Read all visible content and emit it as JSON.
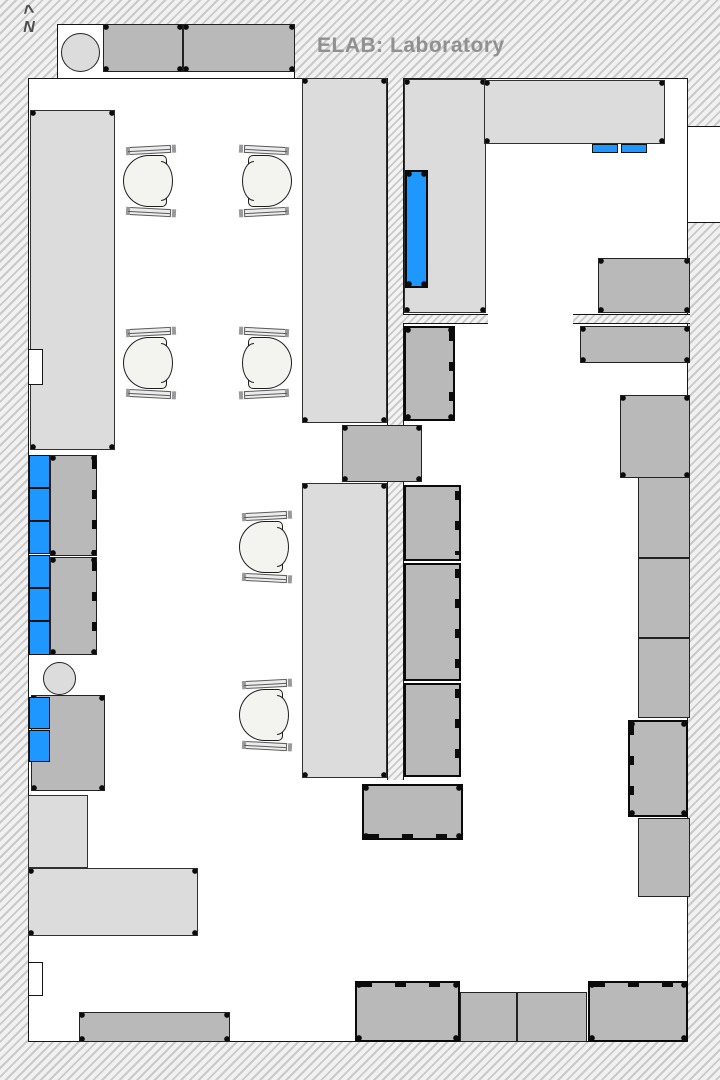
{
  "meta": {
    "title": "ELAB: Laboratory",
    "north_label": "N",
    "north_caret": "^"
  },
  "colors": {
    "accent_blue": "#1e97ff",
    "counter_light": "#dcdcdc",
    "equipment_gray": "#b9b9b9",
    "hatch_line": "#c9c9c9",
    "title_gray": "#909090",
    "seat_fill": "#f3f3ef"
  },
  "floorplan": {
    "rooms": [
      {
        "name": "room-floor",
        "x": 28,
        "y": 78,
        "w": 660,
        "h": 964,
        "cls": []
      },
      {
        "name": "wall-niche",
        "x": 57,
        "y": 24,
        "w": 238,
        "h": 55,
        "cls": []
      },
      {
        "name": "wall-opening-right",
        "x": 688,
        "y": 126,
        "w": 32,
        "h": 97,
        "cls": [
          "open-lr"
        ]
      }
    ],
    "walls": [
      {
        "name": "interior-wall",
        "x": 387,
        "y": 78,
        "w": 17,
        "h": 348,
        "cls": [
          "v"
        ]
      },
      {
        "name": "interior-wall",
        "x": 387,
        "y": 482,
        "w": 17,
        "h": 298,
        "cls": [
          "v"
        ]
      },
      {
        "name": "interior-wall",
        "x": 403,
        "y": 314,
        "w": 85,
        "h": 10,
        "cls": [
          "h"
        ]
      },
      {
        "name": "interior-wall",
        "x": 573,
        "y": 314,
        "w": 117,
        "h": 10,
        "cls": [
          "h"
        ]
      }
    ],
    "blocks": [
      {
        "name": "equipment-bench",
        "x": 103,
        "y": 24,
        "w": 80,
        "h": 48,
        "cls": [
          "mid",
          "mk"
        ]
      },
      {
        "name": "equipment-bench",
        "x": 183,
        "y": 24,
        "w": 112,
        "h": 48,
        "cls": [
          "mid",
          "mk"
        ]
      },
      {
        "name": "stool",
        "x": 61,
        "y": 33,
        "w": 39,
        "h": 39,
        "cls": [
          "circle"
        ]
      },
      {
        "name": "counter-block",
        "x": 30,
        "y": 110,
        "w": 85,
        "h": 340,
        "cls": [
          "light",
          "mk"
        ]
      },
      {
        "name": "counter-block",
        "x": 302,
        "y": 78,
        "w": 85,
        "h": 345,
        "cls": [
          "light",
          "mk"
        ]
      },
      {
        "name": "counter-block",
        "x": 404,
        "y": 79,
        "w": 82,
        "h": 234,
        "cls": [
          "light",
          "mk"
        ]
      },
      {
        "name": "blue-equipment",
        "x": 405,
        "y": 170,
        "w": 23,
        "h": 118,
        "cls": [
          "blue",
          "thick",
          "mk"
        ]
      },
      {
        "name": "counter-block",
        "x": 484,
        "y": 80,
        "w": 181,
        "h": 64,
        "cls": [
          "light",
          "mk"
        ]
      },
      {
        "name": "blue-equipment",
        "x": 592,
        "y": 144,
        "w": 26,
        "h": 9,
        "cls": [
          "blue"
        ]
      },
      {
        "name": "blue-equipment",
        "x": 621,
        "y": 144,
        "w": 26,
        "h": 9,
        "cls": [
          "blue"
        ]
      },
      {
        "name": "equipment-block",
        "x": 404,
        "y": 326,
        "w": 51,
        "h": 95,
        "cls": [
          "mid",
          "thick",
          "tR",
          "mk"
        ]
      },
      {
        "name": "equipment-block",
        "x": 598,
        "y": 258,
        "w": 92,
        "h": 55,
        "cls": [
          "mid",
          "mk"
        ]
      },
      {
        "name": "equipment-block",
        "x": 580,
        "y": 326,
        "w": 110,
        "h": 37,
        "cls": [
          "mid",
          "mk"
        ]
      },
      {
        "name": "equipment-block",
        "x": 620,
        "y": 395,
        "w": 70,
        "h": 83,
        "cls": [
          "mid",
          "mk"
        ]
      },
      {
        "name": "equipment-block",
        "x": 638,
        "y": 477,
        "w": 52,
        "h": 81,
        "cls": [
          "mid"
        ]
      },
      {
        "name": "equipment-block",
        "x": 638,
        "y": 558,
        "w": 52,
        "h": 80,
        "cls": [
          "mid"
        ]
      },
      {
        "name": "equipment-block",
        "x": 638,
        "y": 638,
        "w": 52,
        "h": 80,
        "cls": [
          "mid"
        ]
      },
      {
        "name": "instrument-block",
        "x": 628,
        "y": 720,
        "w": 60,
        "h": 97,
        "cls": [
          "mid",
          "thick",
          "tL",
          "mk"
        ]
      },
      {
        "name": "equipment-block",
        "x": 638,
        "y": 818,
        "w": 52,
        "h": 79,
        "cls": [
          "mid"
        ]
      },
      {
        "name": "equipment-block",
        "x": 50,
        "y": 455,
        "w": 47,
        "h": 101,
        "cls": [
          "mid",
          "mk",
          "tR"
        ]
      },
      {
        "name": "equipment-block",
        "x": 50,
        "y": 557,
        "w": 47,
        "h": 98,
        "cls": [
          "mid",
          "mk",
          "tR"
        ]
      },
      {
        "name": "blue-equipment",
        "x": 29,
        "y": 455,
        "w": 21,
        "h": 33,
        "cls": [
          "blue"
        ]
      },
      {
        "name": "blue-equipment",
        "x": 29,
        "y": 488,
        "w": 21,
        "h": 33,
        "cls": [
          "blue"
        ]
      },
      {
        "name": "blue-equipment",
        "x": 29,
        "y": 521,
        "w": 21,
        "h": 33,
        "cls": [
          "blue"
        ]
      },
      {
        "name": "blue-equipment",
        "x": 29,
        "y": 555,
        "w": 21,
        "h": 33,
        "cls": [
          "blue"
        ]
      },
      {
        "name": "blue-equipment",
        "x": 29,
        "y": 588,
        "w": 21,
        "h": 33,
        "cls": [
          "blue"
        ]
      },
      {
        "name": "blue-equipment",
        "x": 29,
        "y": 621,
        "w": 21,
        "h": 34,
        "cls": [
          "blue"
        ]
      },
      {
        "name": "stool",
        "x": 43,
        "y": 662,
        "w": 33,
        "h": 33,
        "cls": [
          "circle"
        ]
      },
      {
        "name": "equipment-block",
        "x": 31,
        "y": 695,
        "w": 74,
        "h": 96,
        "cls": [
          "mid",
          "mk"
        ]
      },
      {
        "name": "blue-equipment",
        "x": 29,
        "y": 697,
        "w": 21,
        "h": 32,
        "cls": [
          "blue"
        ]
      },
      {
        "name": "blue-equipment",
        "x": 29,
        "y": 730,
        "w": 21,
        "h": 32,
        "cls": [
          "blue"
        ]
      },
      {
        "name": "counter-block",
        "x": 28,
        "y": 795,
        "w": 60,
        "h": 73,
        "cls": [
          "light"
        ]
      },
      {
        "name": "counter-block",
        "x": 28,
        "y": 868,
        "w": 170,
        "h": 68,
        "cls": [
          "light",
          "mk"
        ]
      },
      {
        "name": "equipment-block",
        "x": 79,
        "y": 1012,
        "w": 151,
        "h": 30,
        "cls": [
          "mid",
          "mk"
        ]
      },
      {
        "name": "equipment-block",
        "x": 342,
        "y": 425,
        "w": 80,
        "h": 57,
        "cls": [
          "mid",
          "mk"
        ]
      },
      {
        "name": "counter-block",
        "x": 302,
        "y": 483,
        "w": 85,
        "h": 295,
        "cls": [
          "light",
          "mk"
        ]
      },
      {
        "name": "equipment-block",
        "x": 404,
        "y": 485,
        "w": 57,
        "h": 76,
        "cls": [
          "mid",
          "thick",
          "tR"
        ]
      },
      {
        "name": "equipment-block",
        "x": 404,
        "y": 563,
        "w": 57,
        "h": 118,
        "cls": [
          "mid",
          "thick",
          "tR"
        ]
      },
      {
        "name": "equipment-block",
        "x": 404,
        "y": 683,
        "w": 57,
        "h": 94,
        "cls": [
          "mid",
          "thick",
          "tR"
        ]
      },
      {
        "name": "equipment-block",
        "x": 362,
        "y": 784,
        "w": 101,
        "h": 56,
        "cls": [
          "mid",
          "thick",
          "tB",
          "mk"
        ]
      },
      {
        "name": "equipment-block",
        "x": 355,
        "y": 981,
        "w": 105,
        "h": 61,
        "cls": [
          "mid",
          "thick",
          "tT",
          "mk"
        ]
      },
      {
        "name": "equipment-block",
        "x": 460,
        "y": 992,
        "w": 57,
        "h": 50,
        "cls": [
          "mid"
        ]
      },
      {
        "name": "equipment-block",
        "x": 517,
        "y": 992,
        "w": 70,
        "h": 50,
        "cls": [
          "mid"
        ]
      },
      {
        "name": "equipment-block",
        "x": 588,
        "y": 981,
        "w": 100,
        "h": 61,
        "cls": [
          "mid",
          "thick",
          "tT",
          "mk"
        ]
      }
    ],
    "overlays": [
      {
        "name": "door-notch",
        "x": 28,
        "y": 349,
        "w": 15,
        "h": 36,
        "cls": []
      },
      {
        "name": "door-notch",
        "x": 28,
        "y": 962,
        "w": 15,
        "h": 34,
        "cls": []
      }
    ],
    "chairs": [
      {
        "x": 122,
        "y": 146,
        "facing": "right"
      },
      {
        "x": 238,
        "y": 146,
        "facing": "left"
      },
      {
        "x": 122,
        "y": 328,
        "facing": "right"
      },
      {
        "x": 238,
        "y": 328,
        "facing": "left"
      },
      {
        "x": 238,
        "y": 512,
        "facing": "right"
      },
      {
        "x": 238,
        "y": 680,
        "facing": "right"
      }
    ]
  }
}
